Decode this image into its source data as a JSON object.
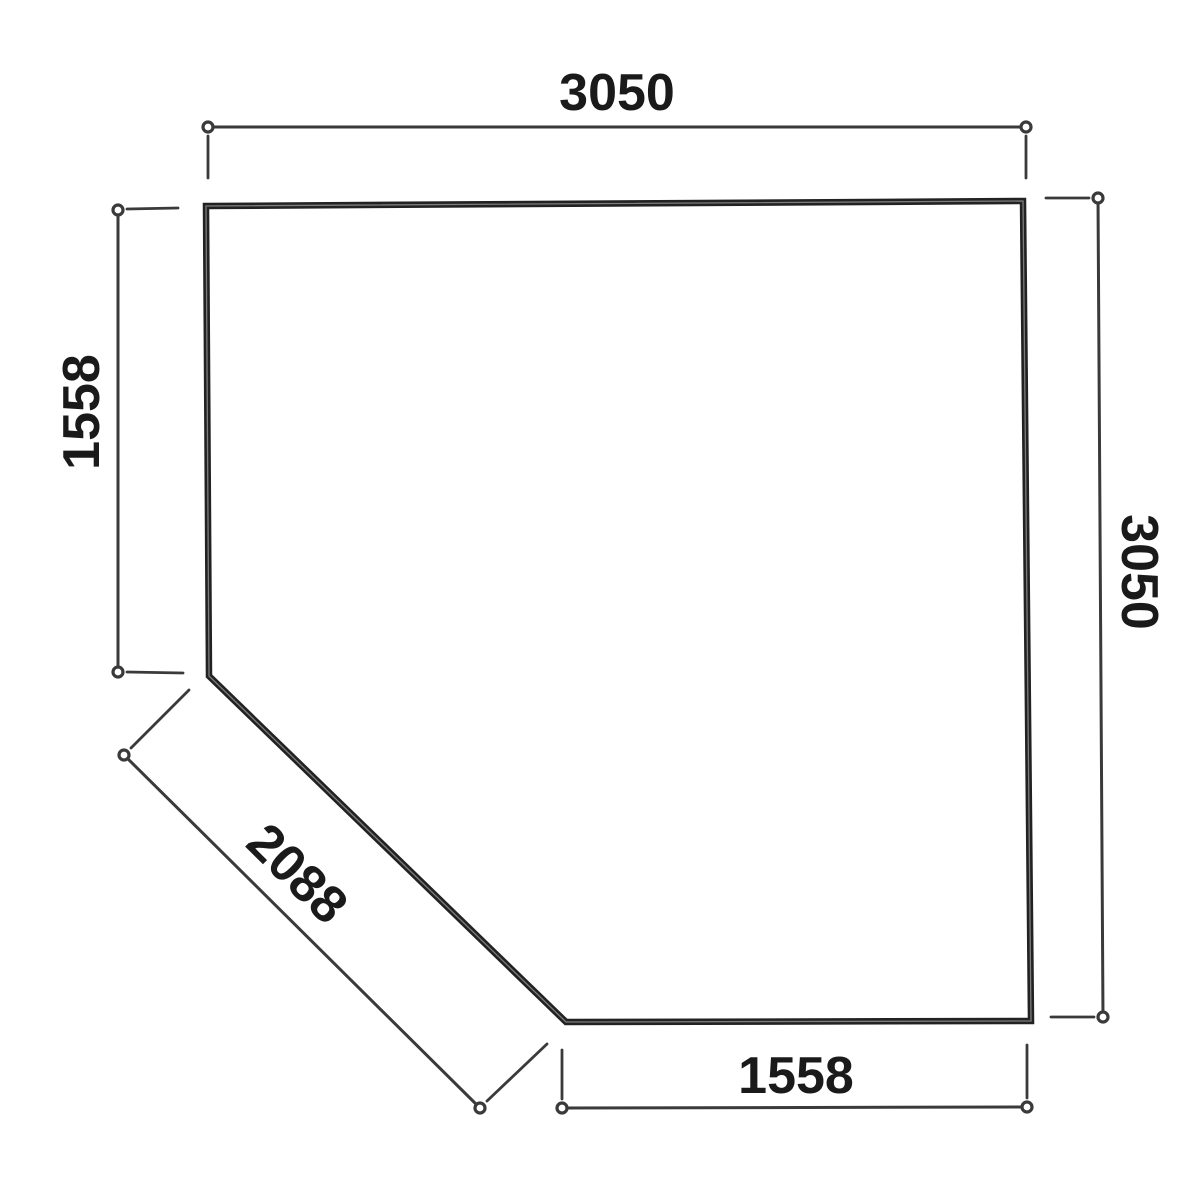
{
  "diagram": {
    "kind": "floor-plan-dimension-drawing",
    "shape": "square-with-cut-corner-pentagon",
    "colors": {
      "background": "#ffffff",
      "wall": "#222222",
      "wall_core": "#8d8d8d",
      "dimension": "#3a3a3a",
      "marker_fill": "#ffffff",
      "text": "#1a1a1a"
    },
    "dimensions": {
      "top": {
        "value": "3050",
        "side": "top edge"
      },
      "right": {
        "value": "3050",
        "side": "right edge"
      },
      "left": {
        "value": "1558",
        "side": "upper left edge"
      },
      "bottom": {
        "value": "1558",
        "side": "bottom edge"
      },
      "diagonal": {
        "value": "2088",
        "side": "cut corner diagonal edge"
      }
    }
  }
}
